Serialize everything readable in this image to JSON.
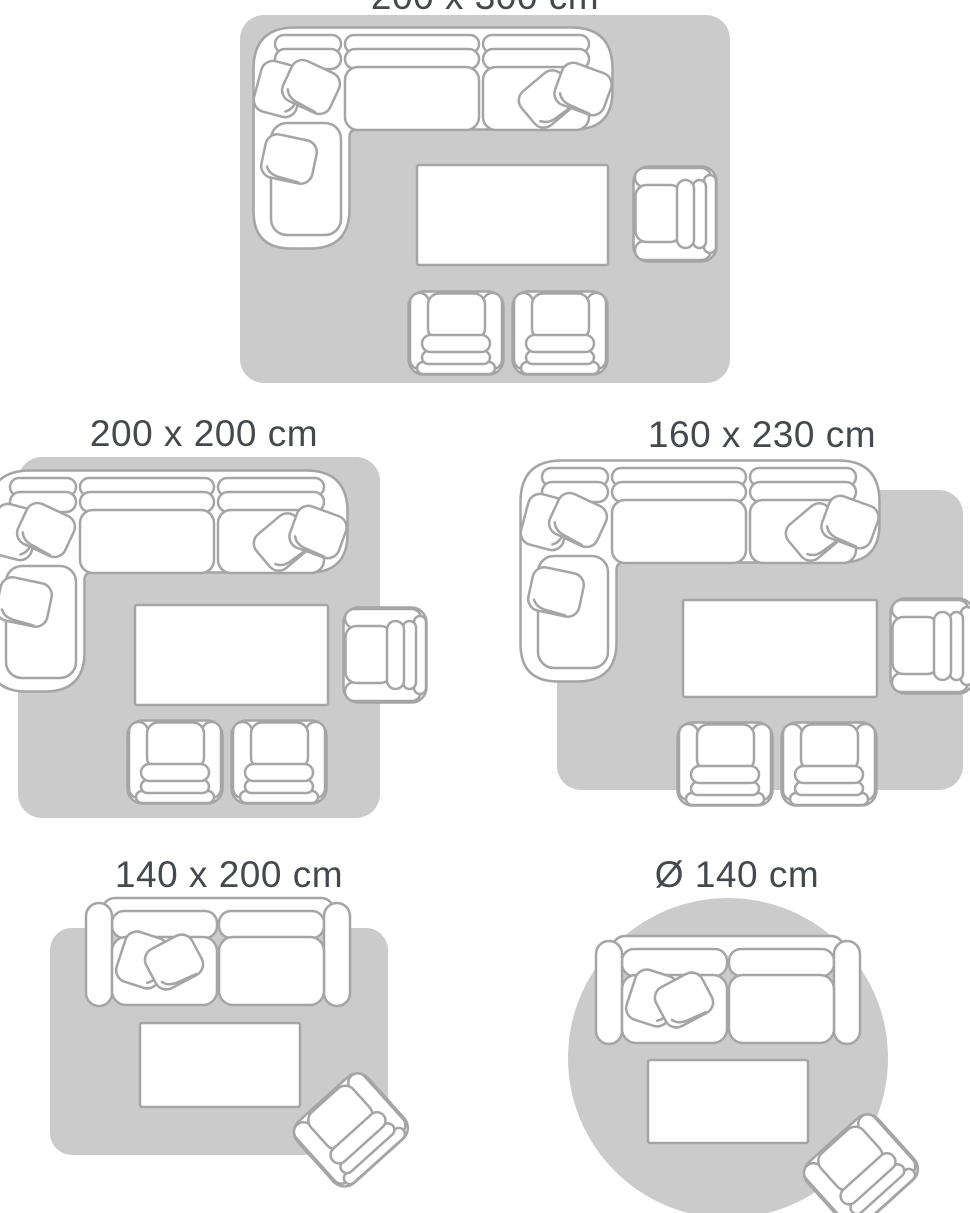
{
  "page": {
    "background": "#ffffff"
  },
  "colors": {
    "background": "#ffffff",
    "rug": "#cbcbcb",
    "furniture_fill": "#ffffff",
    "furniture_outline": "#a5a5a5",
    "label_text": "#45494e"
  },
  "panels": [
    {
      "id": "size-200x300",
      "label": "200 x 300 cm",
      "rug_shape": "rectangle"
    },
    {
      "id": "size-200x200",
      "label": "200 x 200 cm",
      "rug_shape": "rectangle"
    },
    {
      "id": "size-160x230",
      "label": "160 x 230 cm",
      "rug_shape": "rectangle"
    },
    {
      "id": "size-140x200",
      "label": "140 x 200 cm",
      "rug_shape": "rectangle"
    },
    {
      "id": "size-round-140",
      "label": "Ø 140 cm",
      "rug_shape": "circle"
    }
  ],
  "icons": {
    "corner-sofa-icon": "svg-outline-drawing",
    "loveseat-sofa-icon": "svg-outline-drawing",
    "armchair-icon": "svg-outline-drawing",
    "coffee-table-icon": "svg-outline-rect",
    "throw-pillow-icon": "svg-outline-drawing",
    "rug-icon": "svg-gray-shape"
  }
}
